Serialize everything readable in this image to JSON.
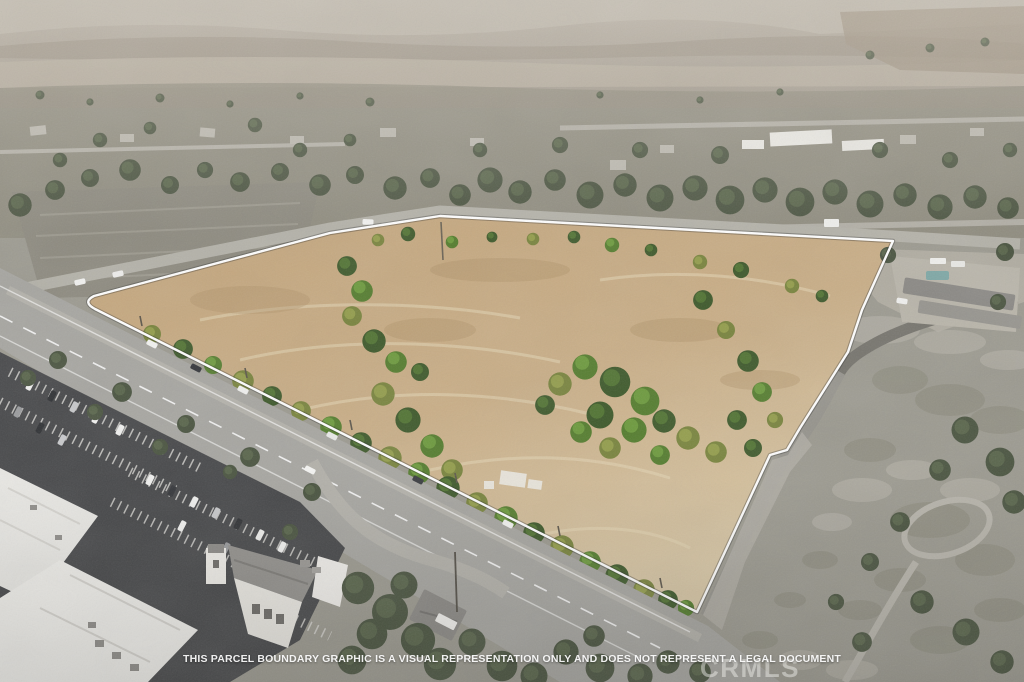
{
  "window": {
    "kind": "aerial-parcel-listing-photo",
    "width_px": 1024,
    "height_px": 682
  },
  "overlay": {
    "disclaimer_text": "THIS PARCEL BOUNDARY GRAPHIC IS A VISUAL REPRESENTATION ONLY AND DOES NOT REPRESENT A LEGAL DOCUMENT",
    "watermark_text": "CRMLS",
    "boundary_color": "#ffffff"
  },
  "scene": {
    "description": "Drone aerial photo of a vacant dry-grass parcel outlined in white; a highway runs along its lower-left edge, retail parking lots and large white rooftops fill the lower-left, a tree-filled suburban neighborhood sits above the parcel, hazy hills line the horizon, and gray scrubland with a winding driveway and a residential compound with a pool lies to the right.",
    "features": [
      "hazy-hills",
      "suburban-neighborhood",
      "graded-gray-field",
      "parcel-dry-grass-field",
      "parcel-tree-clusters",
      "white-parcel-boundary",
      "main-highway",
      "street-above-parcel",
      "retail-parking-lot",
      "big-box-white-roofs",
      "mission-style-building",
      "side-street",
      "small-house-and-trailer",
      "scrubland",
      "curved-driveway",
      "residential-compound-with-pool"
    ]
  },
  "palette": {
    "parcel_tan": "#c8ad85",
    "parcel_tan_light": "#dbc9a8",
    "tree_green_dark": "#3f5a2c",
    "tree_green_bright": "#6d9a3e",
    "tree_olive": "#8f9a4c",
    "suburb_gray": "#8f8d80",
    "hills_haze": "#aba496",
    "asphalt_dark": "#46474a",
    "road_gray": "#a7a6a1",
    "roof_white": "#eeedea",
    "scrub_gray": "#9c9990",
    "pool_teal": "#7fa8a6"
  }
}
